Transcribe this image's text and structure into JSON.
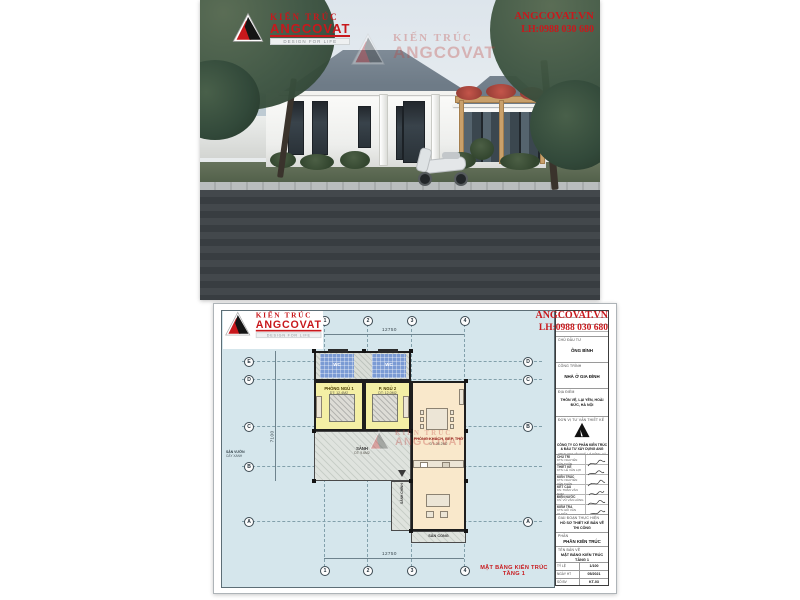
{
  "branding": {
    "accent_red": "#c8181c",
    "logo": {
      "top_text": "KIẾN TRÚC",
      "name": "ANGCOVAT",
      "tagline": "DESIGN FOR LIFE"
    },
    "website": "ANGCOVAT.VN",
    "hotline": "LH:0988 030 680"
  },
  "watermark": {
    "top_text": "KIẾN TRÚC",
    "name": "ANGCOVAT"
  },
  "plan": {
    "sheet_title": "MẶT BẰNG KIẾN TRÚC TẦNG 1",
    "dims": {
      "top": "12750",
      "bottom": "12750",
      "left": "7100"
    },
    "grid": {
      "top": [
        "1",
        "2",
        "3",
        "4"
      ],
      "bottom": [
        "1",
        "2",
        "3",
        "4"
      ],
      "left": [
        "E",
        "D",
        "C",
        "B",
        "A"
      ],
      "right": [
        "D",
        "C",
        "B",
        "A"
      ]
    },
    "rooms": {
      "bedroom1_name": "PHÒNG NGỦ 1",
      "bedroom1_area": "DT: 12.4M2",
      "bedroom2_name": "P. NGỦ 2",
      "bedroom2_area": "DT: 12.0M2",
      "living_name": "PHÒNG KHÁCH, BẾP, THỜ",
      "living_area": "DT: 36.2M2",
      "wc1": "WC",
      "wc2": "WC",
      "hall_name": "SẢNH",
      "hall_area": "DT: 9.6M2",
      "walkway_name": "SẢNH CHÍNH",
      "porch_name": "SÂN CỔNG",
      "porch_area": "DT: 7.2M2",
      "yard_line1": "SÂN VƯỜN",
      "yard_line2": "CÂY XANH"
    }
  },
  "titleblock": {
    "investor_label": "CHỦ ĐẦU TƯ",
    "investor": "ÔNG BÌNH",
    "project_label": "CÔNG TRÌNH",
    "project": "NHÀ Ở GIA ĐÌNH",
    "location_label": "ĐỊA ĐIỂM",
    "location": "THÔN VỆ, LẠI YÊN, HOÀI ĐỨC, HÀ NỘI",
    "consultant_label": "ĐƠN VỊ TƯ VẤN THIẾT KẾ",
    "company_line1": "CÔNG TY CỔ PHẦN KIẾN TRÚC",
    "company_line2": "& ĐẦU TƯ XÂY DỰNG ANG",
    "company_addr": "VPGD: KĐT VĂN KHÊ, HÀ ĐÔNG, HÀ NỘI",
    "signatures": [
      {
        "role": "CHỦ TRÌ",
        "name": "KTS: NGUYỄN VĂN TUẤN"
      },
      {
        "role": "THIẾT KẾ",
        "name": "KTS: LÊ VĂN LỢI"
      },
      {
        "role": "KIẾN TRÚC",
        "name": "KTS: NGUYỄN VĂN TUẤN"
      },
      {
        "role": "KẾT CẤU",
        "name": "KS: TRẦN VĂN NAM"
      },
      {
        "role": "ĐIỆN NƯỚC",
        "name": "KS: VŨ VĂN HÙNG"
      },
      {
        "role": "KIỂM TRA",
        "name": "KTS: ĐỖ VĂN QUYẾT"
      }
    ],
    "stage_label": "GIAI ĐOẠN THỰC HIỆN",
    "stage": "HỒ SƠ THIẾT KẾ BẢN VẼ THI CÔNG",
    "category_label": "PHẦN",
    "category": "PHẦN KIẾN TRÚC",
    "drawing_label": "TÊN BẢN VẼ",
    "drawing": "MẶT BẰNG KIẾN TRÚC TẦNG 1",
    "scale_label": "TỶ LỆ",
    "scale": "1/100",
    "date_label": "NGÀY HT",
    "date": "05/2021",
    "number_label": "SỐ BV",
    "number": "KT-03"
  }
}
